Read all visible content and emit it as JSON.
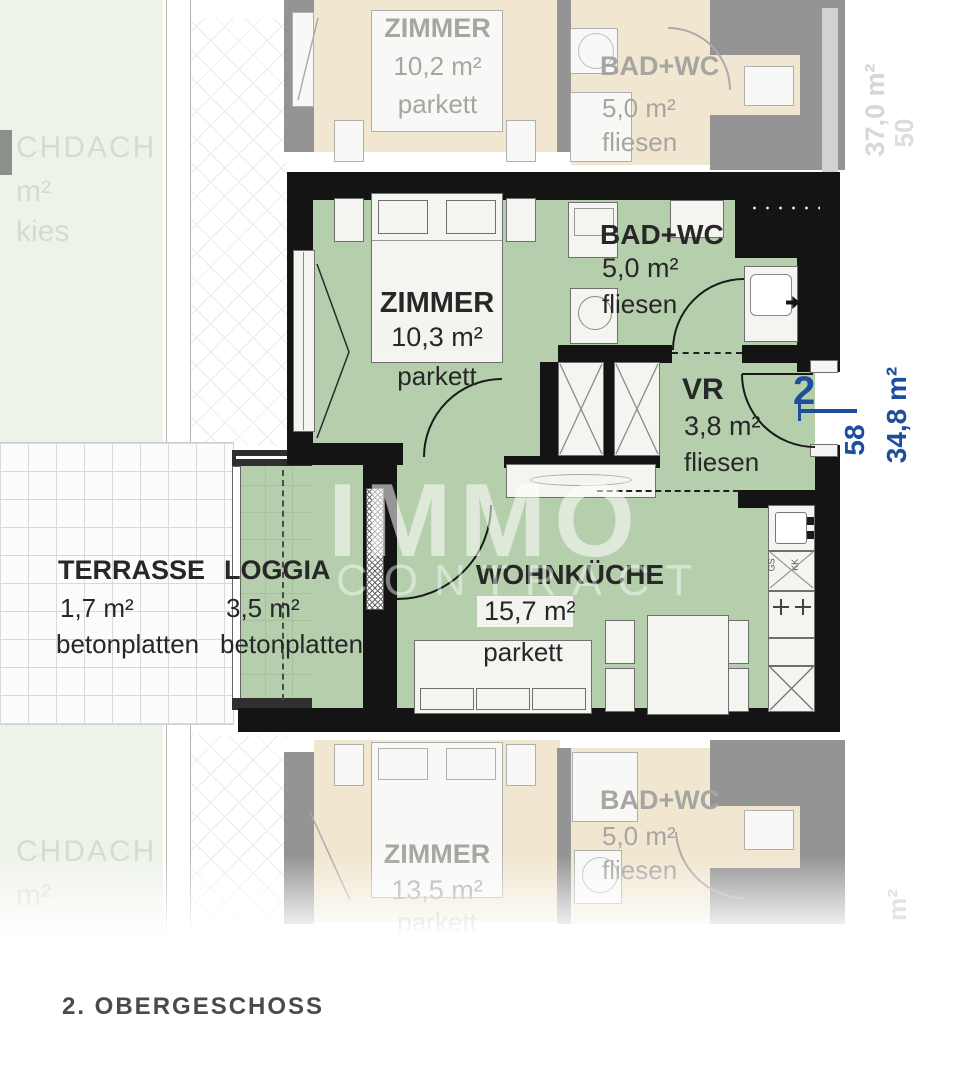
{
  "floorplan": {
    "floor_title": "2. OBERGESCHOSS",
    "watermark": {
      "line1": "IMMO",
      "line2": "CONTRACT"
    },
    "main_unit": {
      "unit_number": "2",
      "door_number": "58",
      "total_area": "34,8 m²",
      "rooms": [
        {
          "name": "ZIMMER",
          "area": "10,3 m²",
          "floor": "parkett"
        },
        {
          "name": "BAD+WC",
          "area": "5,0 m²",
          "floor": "fliesen"
        },
        {
          "name": "VR",
          "area": "3,8 m²",
          "floor": "fliesen"
        },
        {
          "name": "WOHNKÜCHE",
          "area": "15,7 m²",
          "floor": "parkett"
        },
        {
          "name": "LOGGIA",
          "area": "3,5 m²",
          "floor": "betonplatten"
        },
        {
          "name": "TERRASSE",
          "area": "1,7 m²",
          "floor": "betonplatten"
        }
      ],
      "kitchen_labels": {
        "gs": "GS",
        "kk": "KK"
      }
    },
    "upper_unit": {
      "rotated_area": "37,0 m²",
      "rotated_number": "50",
      "rooms": [
        {
          "name": "ZIMMER",
          "area": "10,2 m²",
          "floor": "parkett"
        },
        {
          "name": "BAD+WC",
          "area": "5,0 m²",
          "floor": "fliesen"
        }
      ]
    },
    "lower_unit": {
      "rotated_fragment": "m²",
      "rooms": [
        {
          "name": "ZIMMER",
          "area": "13,5 m²",
          "floor": "parkett"
        },
        {
          "name": "BAD+WC",
          "area": "5,0 m²",
          "floor": "fliesen"
        }
      ]
    },
    "surroundings": {
      "top": {
        "line1": "CHDACH",
        "line2": "m²",
        "line3": "kies"
      },
      "bottom": {
        "line1": "CHDACH",
        "line2": "m²"
      }
    },
    "colors": {
      "floor_green": "#b5cfad",
      "wall_black": "#141414",
      "faded_beige": "#f2e9d7",
      "annotation_blue": "#1e4d9c"
    }
  }
}
